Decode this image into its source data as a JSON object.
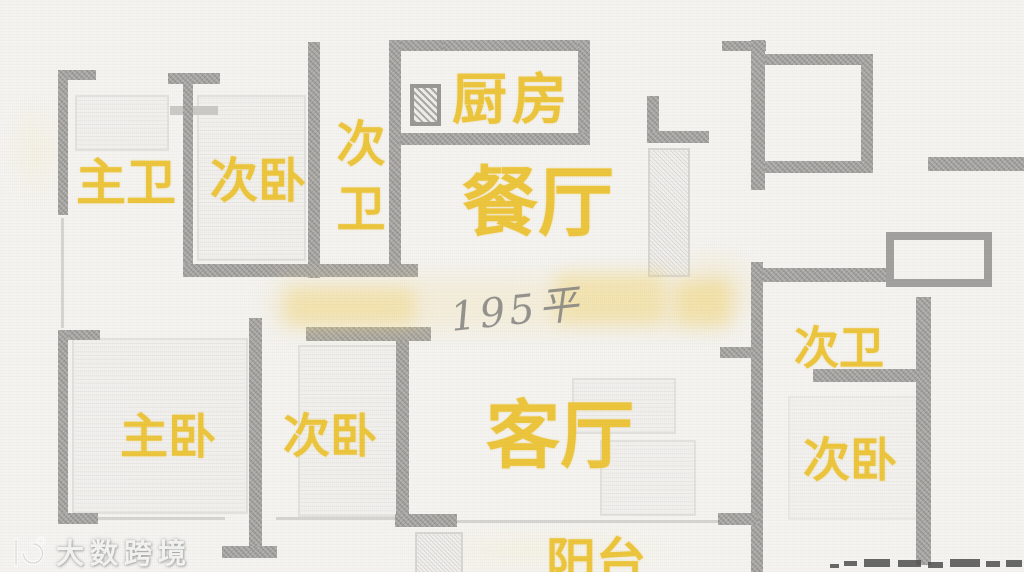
{
  "floorplan": {
    "type": "residential-floor-plan",
    "area_label": "195平",
    "label_color": "#EEC63E",
    "wall_color": "#A3A19E",
    "background_color": "#F5F4F1",
    "area_text_color": "#82827F",
    "rooms": [
      {
        "id": "master-bath",
        "label": "主卫"
      },
      {
        "id": "bedroom-top",
        "label": "次卧"
      },
      {
        "id": "bath-top",
        "label": "次卫"
      },
      {
        "id": "kitchen",
        "label": "厨房"
      },
      {
        "id": "dining-room",
        "label": "餐厅"
      },
      {
        "id": "master-bedroom",
        "label": "主卧"
      },
      {
        "id": "bedroom-left",
        "label": "次卧"
      },
      {
        "id": "living-room",
        "label": "客厅"
      },
      {
        "id": "balcony",
        "label": "阳台"
      },
      {
        "id": "bath-right",
        "label": "次卫"
      },
      {
        "id": "bedroom-right",
        "label": "次卧"
      }
    ]
  },
  "watermarks": {
    "bottom_left_brand": "大数跨境",
    "center_area_note": "195平"
  }
}
